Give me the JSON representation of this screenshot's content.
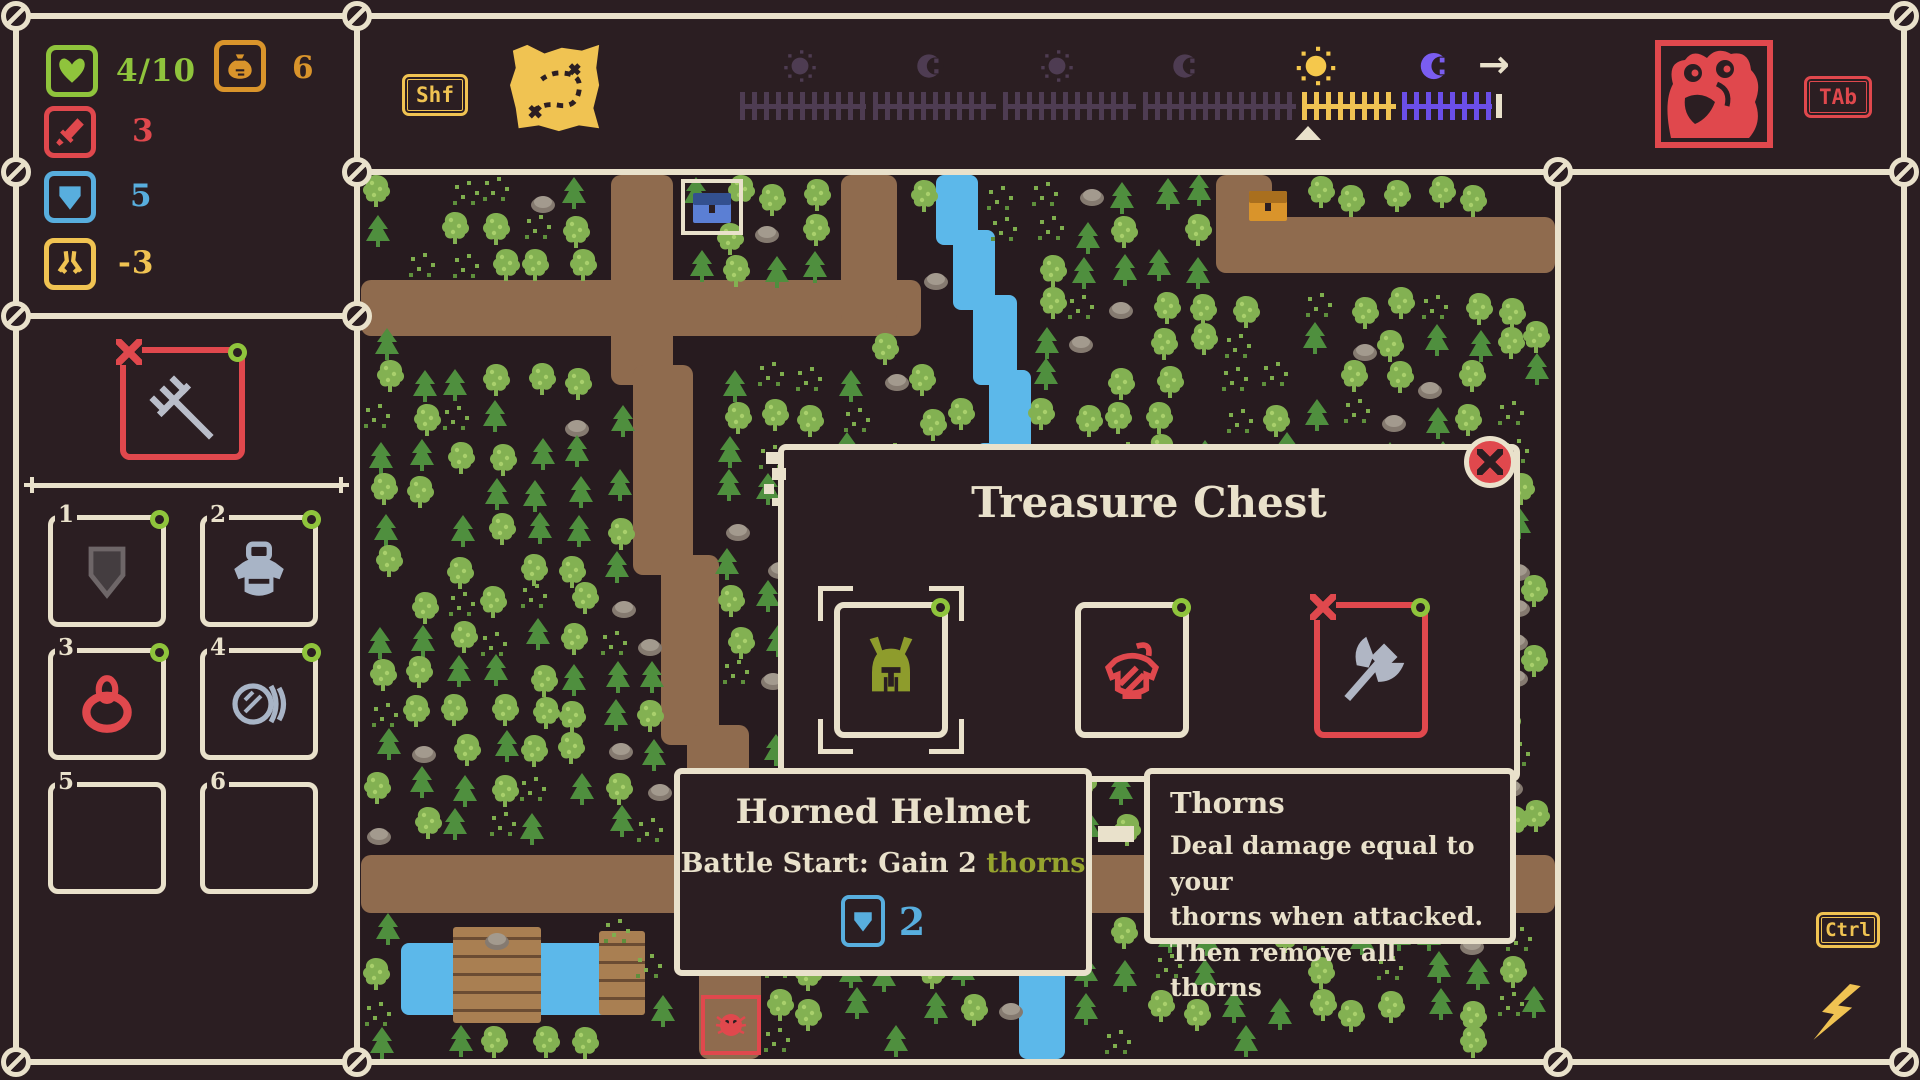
{
  "colors": {
    "beige": "#e9e1cb",
    "red": "#e0484d",
    "green": "#8fc43c",
    "olive": "#96a32e",
    "orange": "#d9942b",
    "blue": "#58aede",
    "yellow": "#f0c352",
    "purple_bright": "#6b4ee8",
    "purple_dim": "#4e3c52",
    "path_brown": "#8f6b4e",
    "water_blue": "#5cb8ea"
  },
  "stats": {
    "health": {
      "icon": "heart-icon",
      "value": "4/10"
    },
    "gold": {
      "icon": "money-bag-icon",
      "value": "6"
    },
    "attack": {
      "icon": "sword-icon",
      "value": "3"
    },
    "defense": {
      "icon": "shield-icon",
      "value": "5"
    },
    "speed": {
      "icon": "greaves-icon",
      "value": "-3"
    }
  },
  "hotkeys": {
    "shift": "Shf",
    "tab": "TAb",
    "ctrl": "Ctrl"
  },
  "equipped": {
    "item_icon": "pitchfork-icon",
    "cursed": true
  },
  "inventory": {
    "slots": [
      {
        "number": "1",
        "item_icon": "shield-item-icon"
      },
      {
        "number": "2",
        "item_icon": "armor-item-icon"
      },
      {
        "number": "3",
        "item_icon": "ring-item-icon"
      },
      {
        "number": "4",
        "item_icon": "bandage-roll-icon"
      },
      {
        "number": "5",
        "item_icon": ""
      },
      {
        "number": "6",
        "item_icon": ""
      }
    ]
  },
  "timeline": {
    "icons": [
      "sun-dim",
      "moon-dim",
      "sun-dim",
      "moon-dim",
      "sun-current",
      "moon-upcoming"
    ],
    "marker": "current-time-marker"
  },
  "enemy": {
    "portrait_icon": "red-beast-portrait"
  },
  "modal": {
    "title": "Treasure Chest",
    "close_icon": "close-x-icon",
    "items": [
      {
        "icon": "horned-helmet-icon",
        "selected": true
      },
      {
        "icon": "red-armor-icon"
      },
      {
        "icon": "battle-axe-icon",
        "cursed": true
      }
    ]
  },
  "item_tooltip": {
    "title": "Horned Helmet",
    "effect_prefix": "Battle Start: Gain 2 ",
    "effect_keyword": "thorns",
    "stat_icon": "shield-icon",
    "stat_value": "2"
  },
  "keyword_tooltip": {
    "title": "Thorns",
    "line1": "Deal damage equal to your",
    "line2": "thorns when attacked.",
    "line3": "Then remove all thorns"
  }
}
